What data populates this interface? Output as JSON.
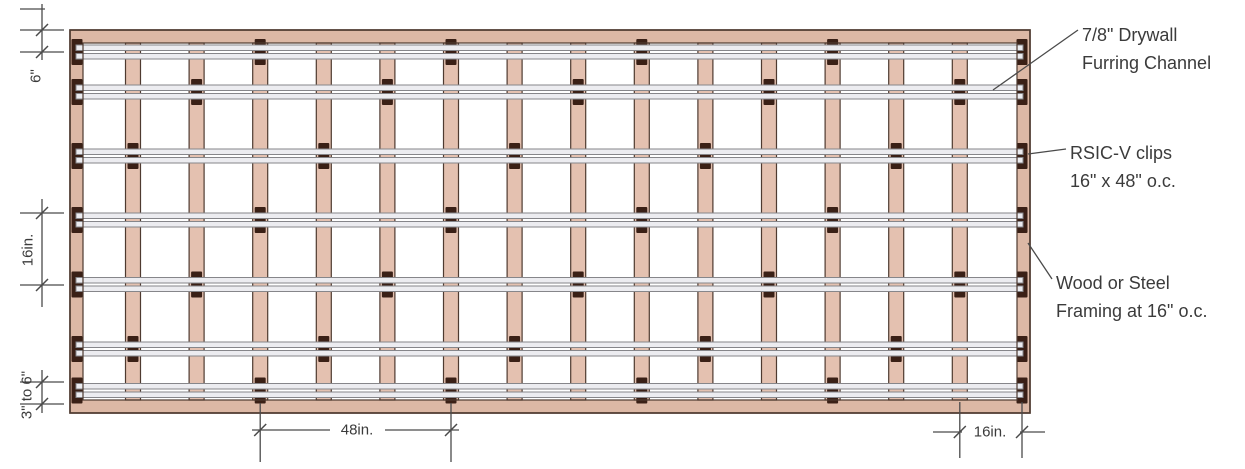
{
  "figure": {
    "type": "construction-detail-diagram",
    "subject": "RSIC-V sound isolation clip and drywall furring channel layout on framing"
  },
  "labels": {
    "furring": {
      "line1": "7/8\" Drywall",
      "line2": "Furring Channel"
    },
    "clips": {
      "line1": "RSIC-V clips",
      "line2": "16\" x 48\" o.c."
    },
    "framing": {
      "line1": "Wood or Steel",
      "line2": "Framing at 16\" o.c."
    }
  },
  "dimensions": {
    "top_left": "6\"",
    "mid_left": "16in.",
    "bottom_left": "3\" to 6\"",
    "bottom_center": "48in.",
    "bottom_right": "16in."
  },
  "colors": {
    "frame": "#dcb8a5",
    "stud": "#e4c1b0",
    "outline": "#4e3a30",
    "channel_fill": "#ececf0",
    "channel_stroke": "#86868a",
    "clip": "#3a2016",
    "dim_line": "#4a4a4a",
    "text": "#3b3b3b"
  },
  "diagram": {
    "frame": {
      "x": 70,
      "y": 30,
      "w": 960,
      "h": 383,
      "border": 13
    },
    "stud_lines_x": [
      77,
      133,
      196.6,
      260.2,
      323.8,
      387.4,
      451,
      514.6,
      578.2,
      641.8,
      705.4,
      769,
      832.6,
      896.2,
      959.8,
      1022
    ],
    "stud_width": 15,
    "channel_rows_y": [
      52,
      92,
      156,
      220,
      284.5,
      349,
      390.5
    ],
    "channel_span_x": [
      76,
      1023
    ],
    "clip_pattern": [
      [
        0,
        3,
        6,
        9,
        12,
        15
      ],
      [
        0,
        2,
        5,
        8,
        11,
        14,
        15
      ],
      [
        0,
        1,
        4,
        7,
        10,
        13,
        15
      ],
      [
        0,
        3,
        6,
        9,
        12,
        15
      ],
      [
        0,
        2,
        5,
        8,
        11,
        14,
        15
      ],
      [
        0,
        1,
        4,
        7,
        10,
        13,
        15
      ],
      [
        0,
        3,
        6,
        9,
        12,
        15
      ]
    ],
    "leaders": [
      {
        "from": [
          1078,
          30
        ],
        "to": [
          993,
          90
        ]
      },
      {
        "from": [
          1066,
          149
        ],
        "to": [
          1028,
          154
        ]
      },
      {
        "from": [
          1052,
          279
        ],
        "to": [
          1028,
          243
        ]
      }
    ]
  }
}
